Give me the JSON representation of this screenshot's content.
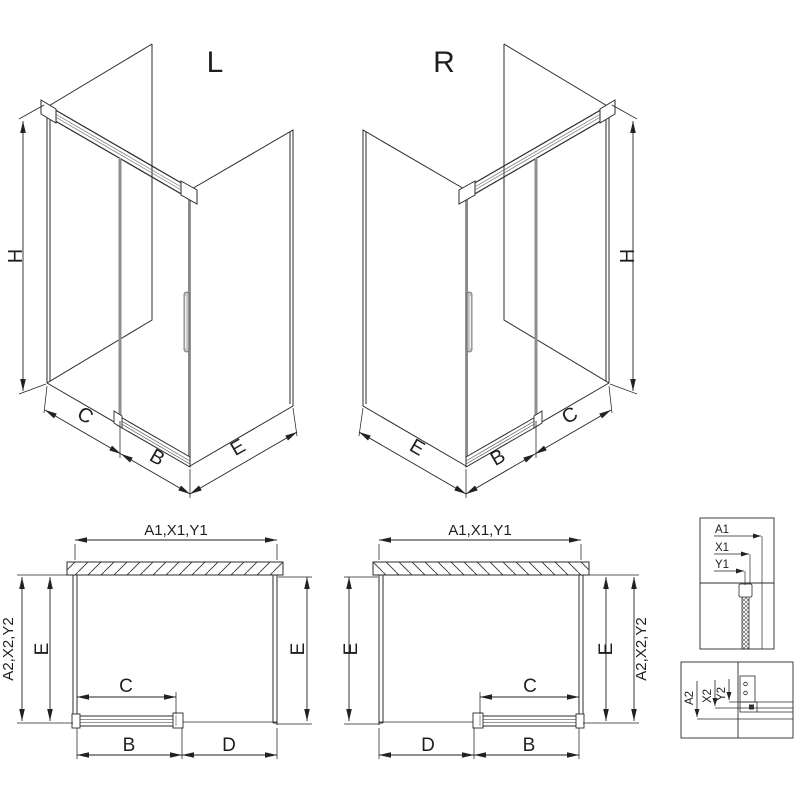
{
  "colors": {
    "ink": "#2b2b2b",
    "dim_line": "#222222",
    "glass_edge_gray": "#8f8f8f",
    "handle_gray": "#c4c4c4",
    "background": "#ffffff"
  },
  "iso_left": {
    "label": "L",
    "dim_height": "H",
    "dim_fixed": "C",
    "dim_door": "B",
    "dim_side": "E"
  },
  "iso_right": {
    "label": "R",
    "dim_height": "H",
    "dim_fixed": "C",
    "dim_door": "B",
    "dim_side": "E"
  },
  "plan_left": {
    "dim_width": "A1,X1,Y1",
    "dim_depth": "A2,X2,Y2",
    "dim_side_left": "E",
    "dim_side_right": "E",
    "dim_opening": "C",
    "dim_door": "B",
    "dim_panel": "D"
  },
  "plan_right": {
    "dim_width": "A1,X1,Y1",
    "dim_depth": "A2,X2,Y2",
    "dim_side_left": "E",
    "dim_side_right": "E",
    "dim_opening": "C",
    "dim_door": "B",
    "dim_panel": "D"
  },
  "detail_wall_profile": {
    "dim_a": "A1",
    "dim_x": "X1",
    "dim_y": "Y1"
  },
  "detail_floor_profile": {
    "dim_a": "A2",
    "dim_x": "X2",
    "dim_y": "Y2"
  }
}
